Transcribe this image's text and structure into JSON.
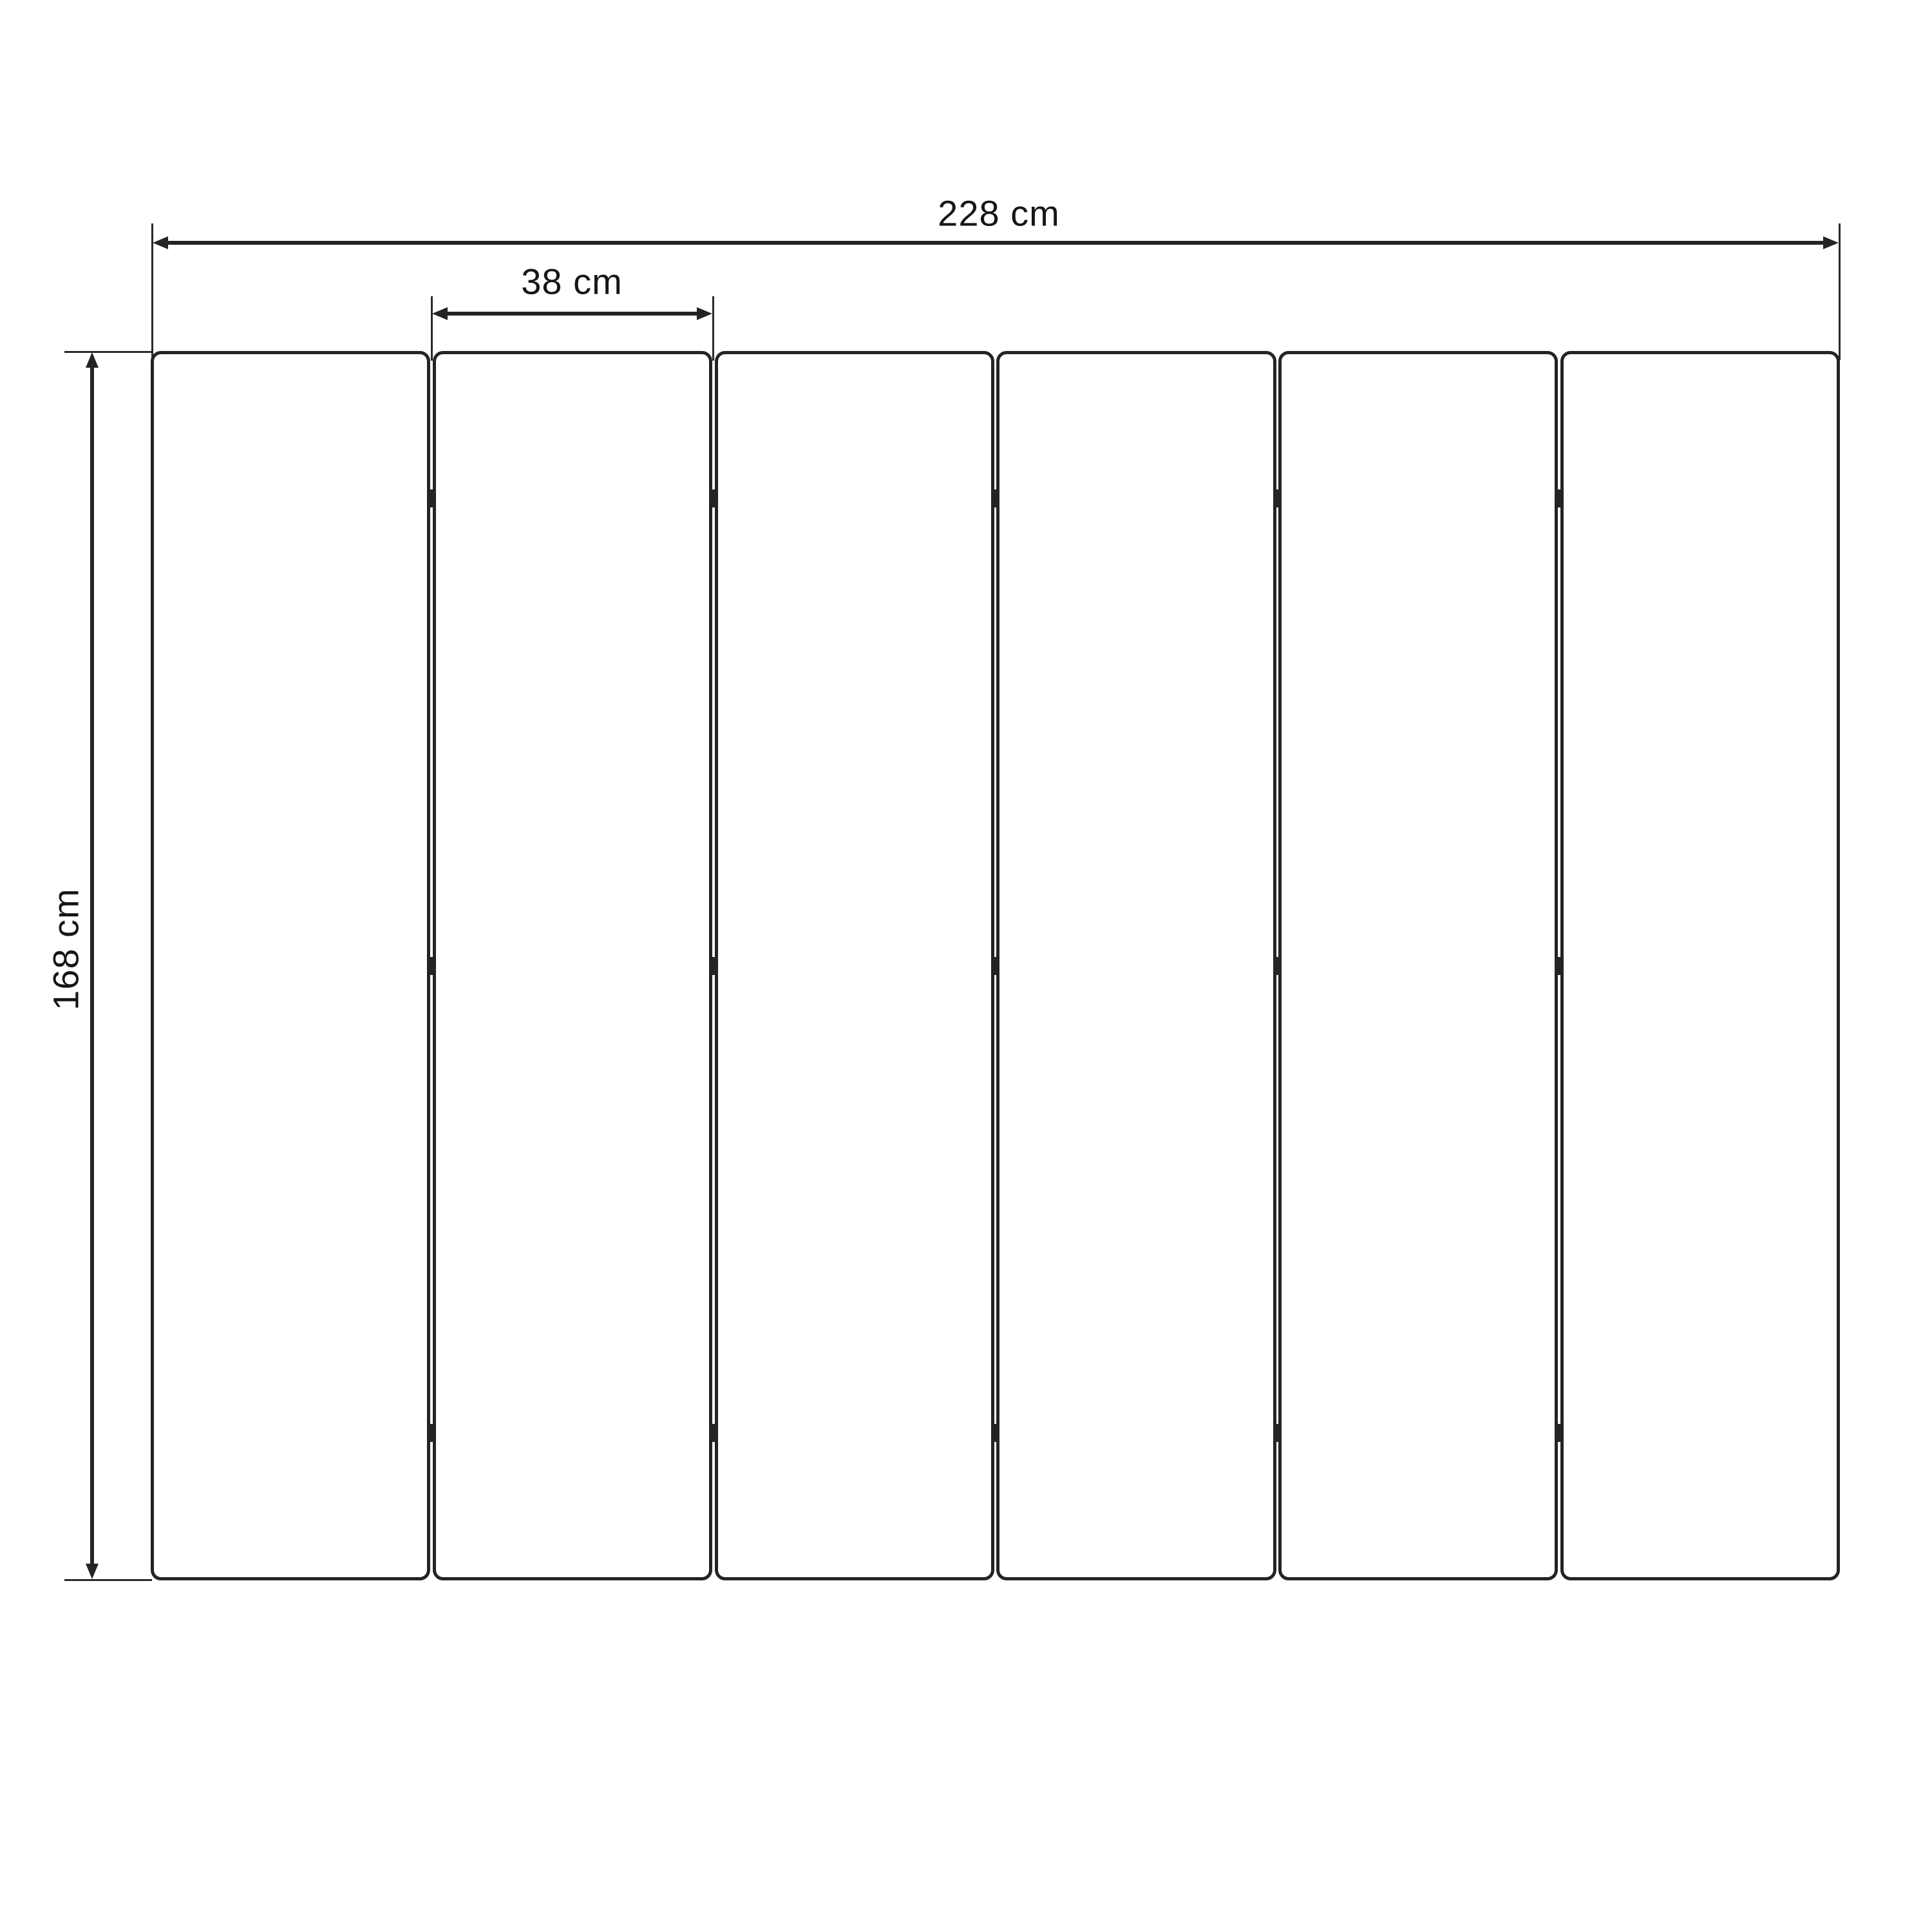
{
  "diagram": {
    "type": "technical-drawing",
    "subject": "six-panel folding screen, front elevation",
    "dimension_labels": {
      "total_width": "228 cm",
      "panel_width": "38 cm",
      "height": "168 cm"
    },
    "panel_count": 6,
    "joint_count": 5,
    "hinges_per_joint": 3,
    "hinge_vertical_fractions": [
      0.12,
      0.5,
      0.88
    ],
    "colors": {
      "line": "#242424",
      "text": "#161616",
      "background": "#ffffff"
    }
  }
}
